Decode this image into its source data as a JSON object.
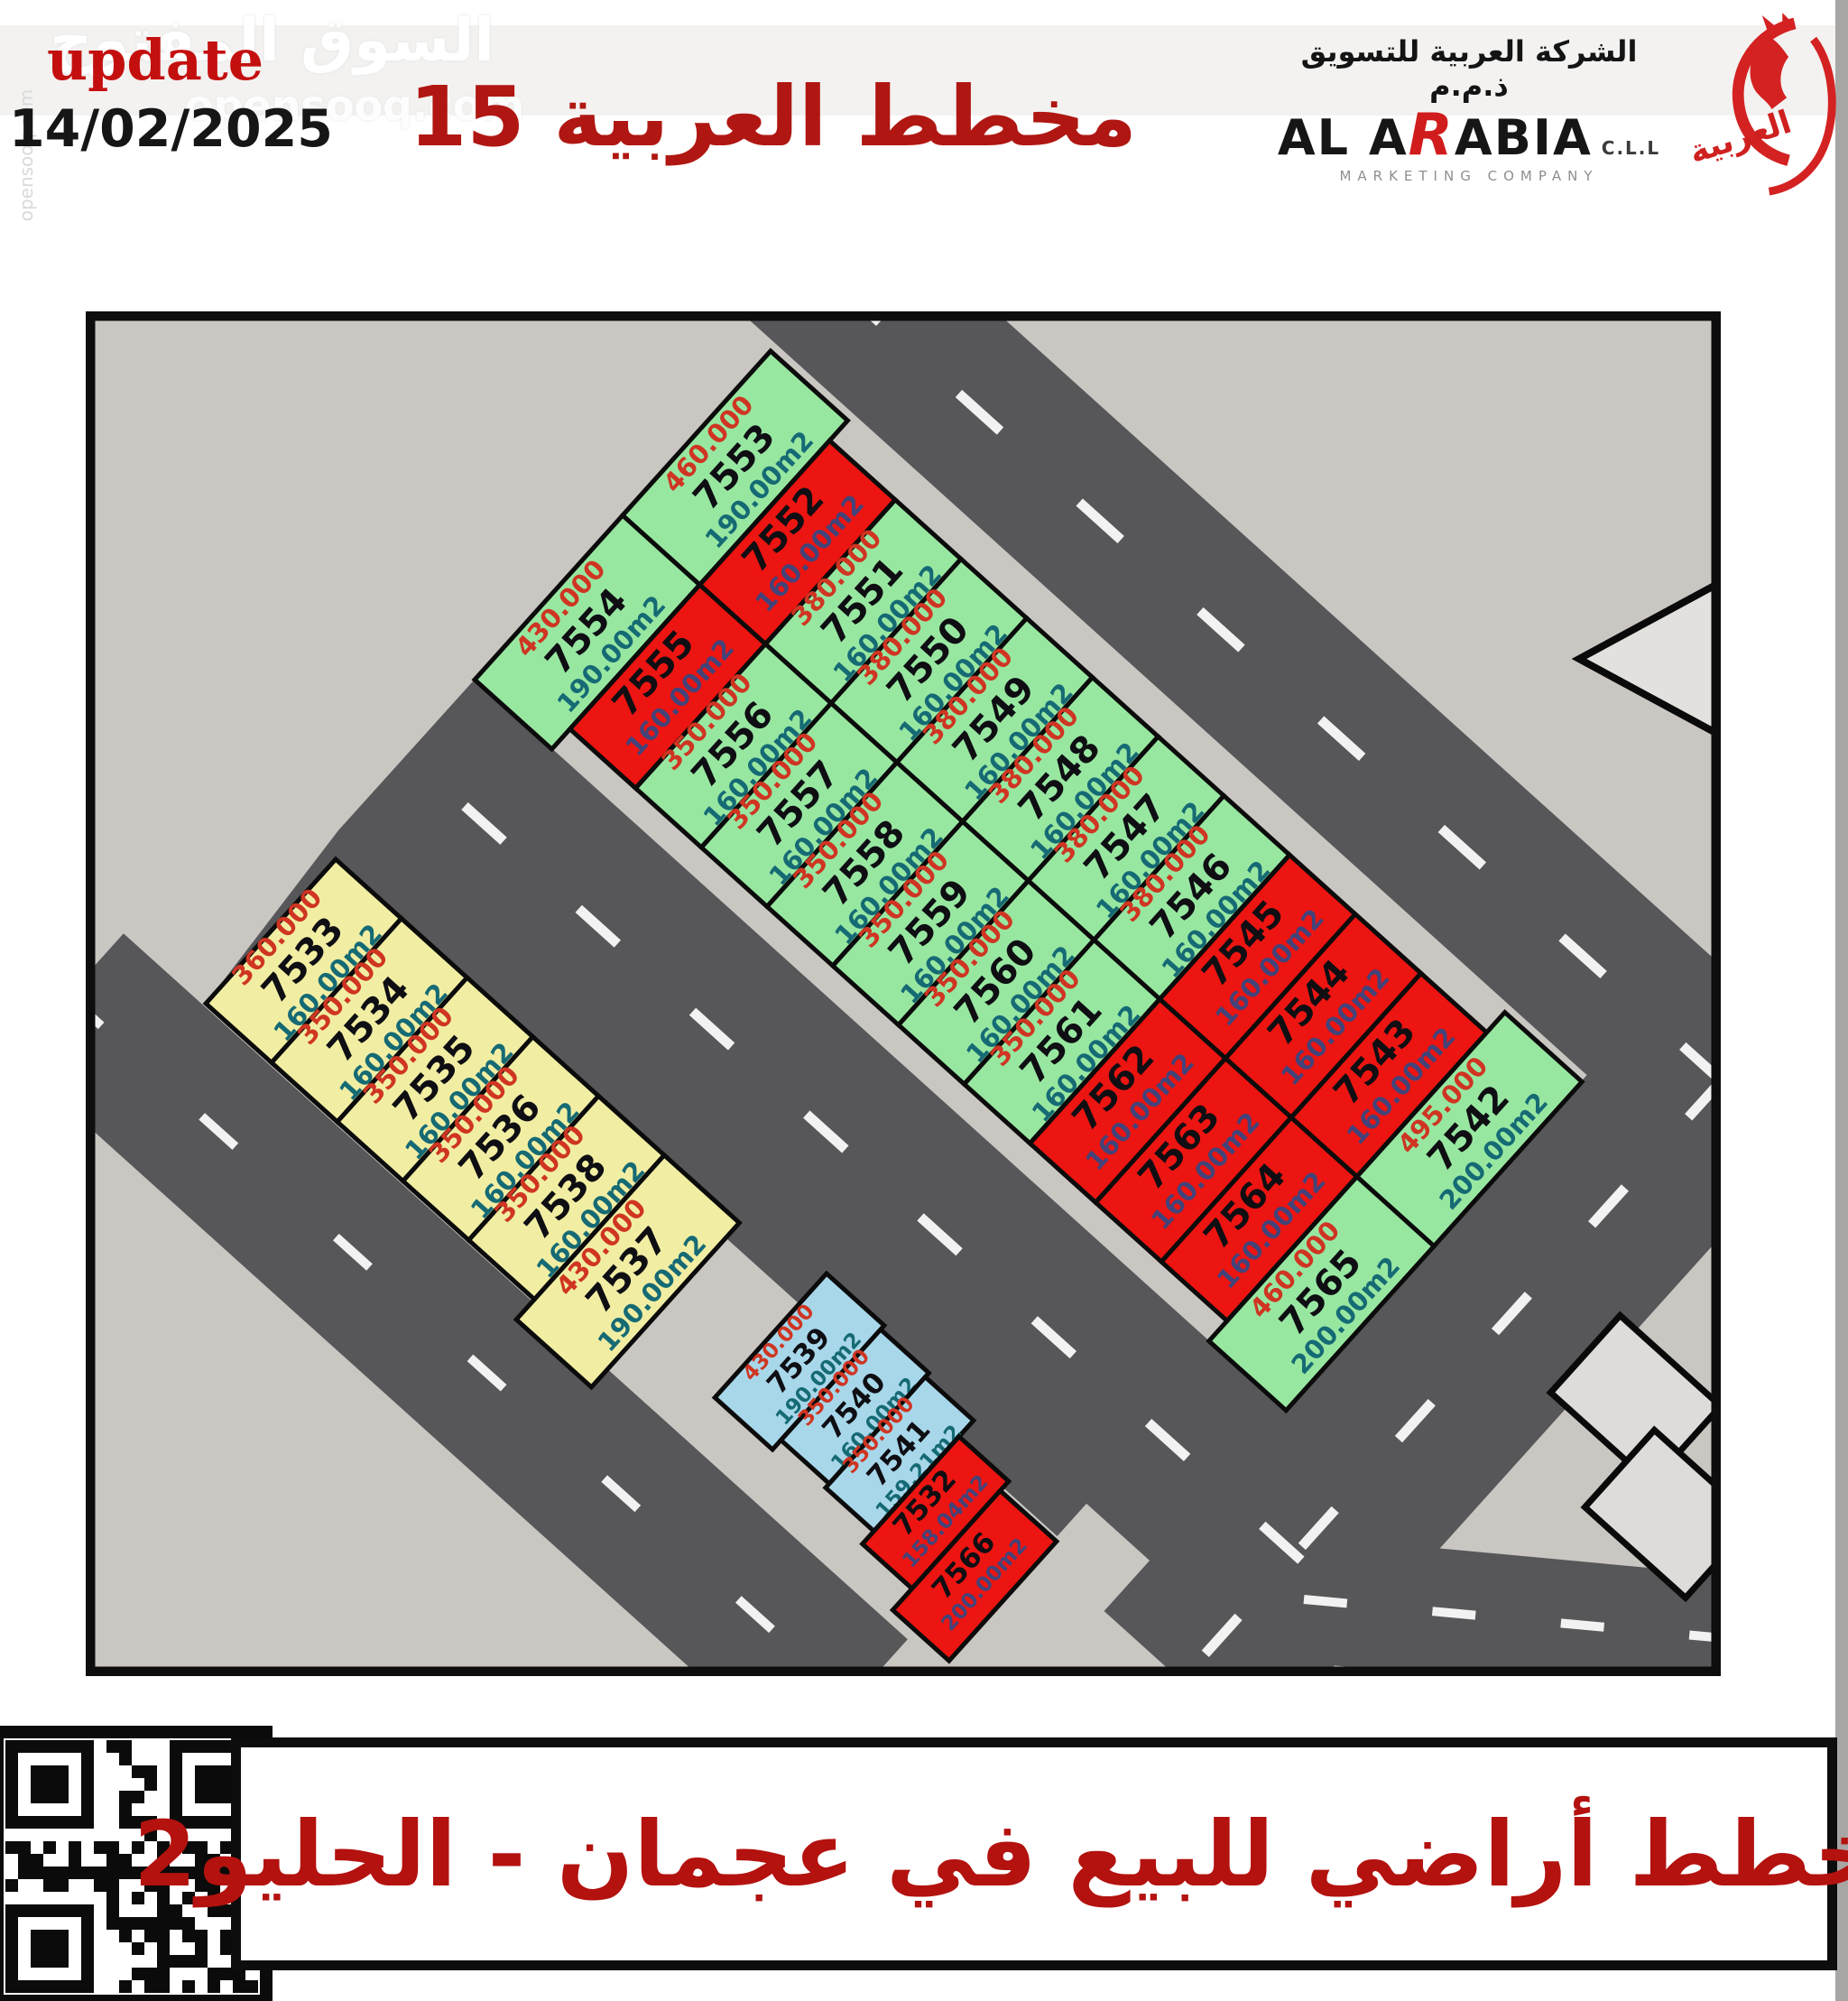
{
  "header": {
    "watermark": {
      "site_name_ar": "السوق المفتوح",
      "site_domain": "opensooq.com"
    },
    "update_label": "update",
    "update_date": "14/02/2025",
    "title": "مخطط العربية 15",
    "logo": {
      "company_ar": "الشركة العربية للتسويق ذ.م.م",
      "brand_pre": "AL A",
      "brand_r": "R",
      "brand_post": "ABIA",
      "brand_suffix": "C.L.L",
      "tagline": "MARKETING COMPANY",
      "emblem_word_ar": "العربية"
    }
  },
  "colors": {
    "green_plot": "#98e7a1",
    "red_plot": "#ec1511",
    "yellow_plot": "#f1eea3",
    "blue_plot": "#a8d7ea",
    "road": "#57575a",
    "map_background": "#cac7c3",
    "price_text": "#cf3522",
    "number_text": "#0e0e13",
    "area_text": "#156a74",
    "area_text_on_red": "#43437a",
    "accent_red": "#b3120f"
  },
  "map": {
    "blocks": {
      "row_top": {
        "plots": [
          {
            "no": "7553",
            "price": "460.000",
            "area": "190.00m2",
            "color": "green"
          },
          {
            "no": "7552",
            "price": "",
            "area": "160.00m2",
            "color": "red"
          },
          {
            "no": "7551",
            "price": "380.000",
            "area": "160.00m2",
            "color": "green"
          },
          {
            "no": "7550",
            "price": "380.000",
            "area": "160.00m2",
            "color": "green"
          },
          {
            "no": "7549",
            "price": "380.000",
            "area": "160.00m2",
            "color": "green"
          },
          {
            "no": "7548",
            "price": "380.000",
            "area": "160.00m2",
            "color": "green"
          },
          {
            "no": "7547",
            "price": "380.000",
            "area": "160.00m2",
            "color": "green"
          },
          {
            "no": "7546",
            "price": "380.000",
            "area": "160.00m2",
            "color": "green"
          },
          {
            "no": "7545",
            "price": "",
            "area": "160.00m2",
            "color": "red"
          },
          {
            "no": "7544",
            "price": "",
            "area": "160.00m2",
            "color": "red"
          },
          {
            "no": "7543",
            "price": "",
            "area": "160.00m2",
            "color": "red"
          },
          {
            "no": "7542",
            "price": "495.000",
            "area": "200.00m2",
            "color": "green"
          }
        ]
      },
      "row_bottom": {
        "plots": [
          {
            "no": "7554",
            "price": "430.000",
            "area": "190.00m2",
            "color": "green"
          },
          {
            "no": "7555",
            "price": "",
            "area": "160.00m2",
            "color": "red"
          },
          {
            "no": "7556",
            "price": "350.000",
            "area": "160.00m2",
            "color": "green"
          },
          {
            "no": "7557",
            "price": "350.000",
            "area": "160.00m2",
            "color": "green"
          },
          {
            "no": "7558",
            "price": "350.000",
            "area": "160.00m2",
            "color": "green"
          },
          {
            "no": "7559",
            "price": "350.000",
            "area": "160.00m2",
            "color": "green"
          },
          {
            "no": "7560",
            "price": "350.000",
            "area": "160.00m2",
            "color": "green"
          },
          {
            "no": "7561",
            "price": "350.000",
            "area": "160.00m2",
            "color": "green"
          },
          {
            "no": "7562",
            "price": "",
            "area": "160.00m2",
            "color": "red"
          },
          {
            "no": "7563",
            "price": "",
            "area": "160.00m2",
            "color": "red"
          },
          {
            "no": "7564",
            "price": "",
            "area": "160.00m2",
            "color": "red"
          },
          {
            "no": "7565",
            "price": "460.000",
            "area": "200.00m2",
            "color": "green"
          }
        ]
      },
      "yellow_row": {
        "plots": [
          {
            "no": "7533",
            "price": "360.000",
            "area": "160.00m2",
            "color": "yellow"
          },
          {
            "no": "7534",
            "price": "350.000",
            "area": "160.00m2",
            "color": "yellow"
          },
          {
            "no": "7535",
            "price": "350.000",
            "area": "160.00m2",
            "color": "yellow"
          },
          {
            "no": "7536",
            "price": "350.000",
            "area": "160.00m2",
            "color": "yellow"
          },
          {
            "no": "7538",
            "price": "350.000",
            "area": "160.00m2",
            "color": "yellow"
          },
          {
            "no": "7537",
            "price": "430.000",
            "area": "190.00m2",
            "color": "yellow"
          }
        ]
      },
      "lower_row": {
        "plots": [
          {
            "no": "7539",
            "price": "430.000",
            "area": "190.00m2",
            "color": "blue"
          },
          {
            "no": "7540",
            "price": "350.000",
            "area": "160.00m2",
            "color": "blue"
          },
          {
            "no": "7541",
            "price": "350.000",
            "area": "159.21m2",
            "color": "blue"
          },
          {
            "no": "7532",
            "price": "",
            "area": "158.04m2",
            "color": "red"
          },
          {
            "no": "7566",
            "price": "",
            "area": "200.00m2",
            "color": "red"
          }
        ]
      }
    }
  },
  "footer": {
    "caption": "مخطط أراضي للبيع في عجمان - الحليو2"
  }
}
